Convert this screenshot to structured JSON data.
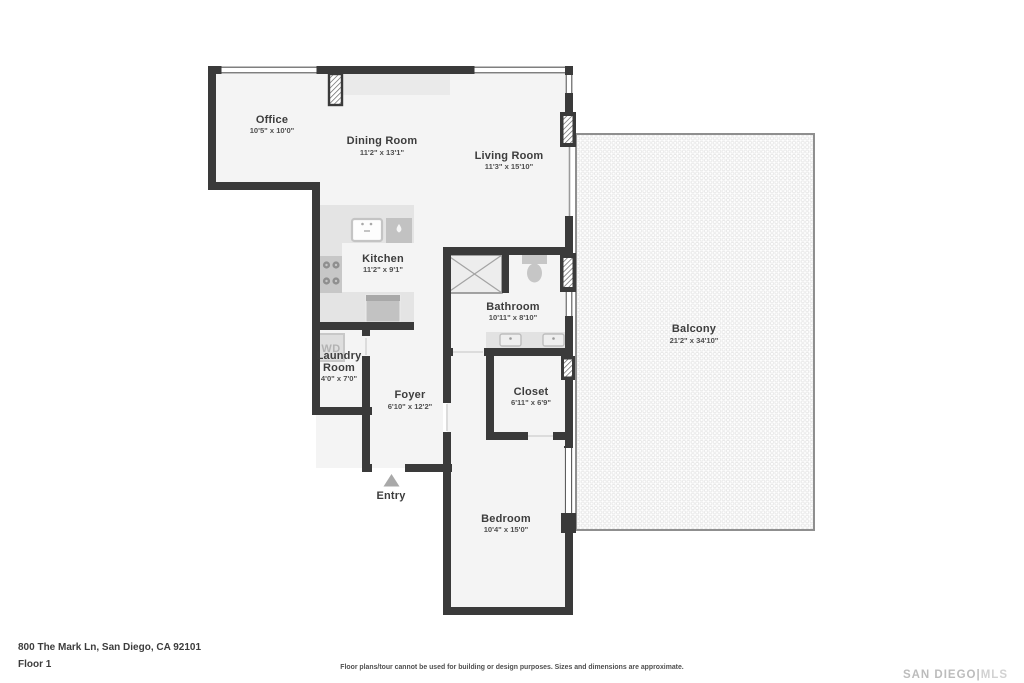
{
  "address": "800 The Mark Ln, San Diego, CA 92101",
  "floor_label": "Floor 1",
  "disclaimer": "Floor plans/tour cannot be used for building or design purposes. Sizes and dimensions are approximate.",
  "logo": {
    "part1": "SAN DIEGO",
    "separator": "|",
    "part2": "MLS"
  },
  "entry_label": "Entry",
  "wd_label": "WD",
  "rooms": {
    "office": {
      "name": "Office",
      "dims": "10'5\" x 10'0\""
    },
    "dining": {
      "name": "Dining Room",
      "dims": "11'2\" x 13'1\""
    },
    "living": {
      "name": "Living Room",
      "dims": "11'3\" x 15'10\""
    },
    "kitchen": {
      "name": "Kitchen",
      "dims": "11'2\" x 9'1\""
    },
    "bathroom": {
      "name": "Bathroom",
      "dims": "10'11\" x 8'10\""
    },
    "laundry": {
      "name_line1": "Laundry",
      "name_line2": "Room",
      "dims": "4'0\" x 7'0\""
    },
    "foyer": {
      "name": "Foyer",
      "dims": "6'10\" x 12'2\""
    },
    "closet": {
      "name": "Closet",
      "dims": "6'11\" x 6'9\""
    },
    "bedroom": {
      "name": "Bedroom",
      "dims": "10'4\" x 15'0\""
    },
    "balcony": {
      "name": "Balcony",
      "dims": "21'2\" x 34'10\""
    }
  },
  "colors": {
    "wall": "#3a3a3a",
    "floor_fill": "#f4f4f4",
    "counter_fill": "#e4e4e4",
    "appliance_fill": "#c2c2c2",
    "balcony_border": "#8f8f8f",
    "balcony_dot": "#e7e7e7",
    "label_text": "#3d3d3d",
    "logo_gray": "#bcbcbc",
    "entry_arrow": "#a9a9a9"
  }
}
